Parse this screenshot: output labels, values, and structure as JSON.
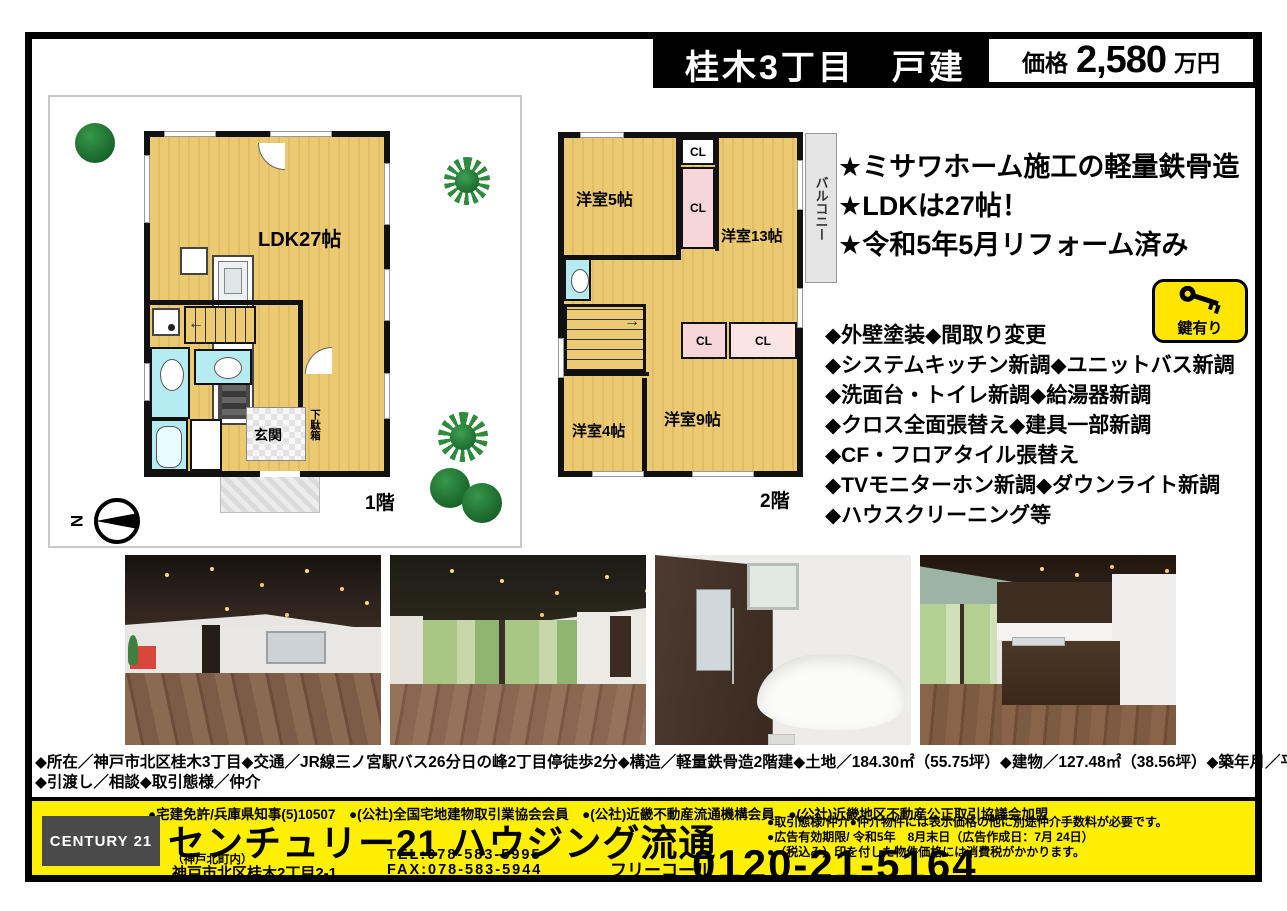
{
  "header": {
    "title": "桂木3丁目　戸建",
    "price_label": "価格",
    "price_value": "2,580",
    "price_unit": "万円"
  },
  "floorplan1": {
    "floor_label": "1階",
    "ldk_label": "LDK27帖",
    "genkan_label": "玄関",
    "shoebox_label": "下駄箱",
    "compass_n": "N"
  },
  "floorplan2": {
    "floor_label": "2階",
    "room5_label": "洋室5帖",
    "room13_label": "洋室13帖",
    "room4_label": "洋室4帖",
    "room9_label": "洋室9帖",
    "closet_label": "CL",
    "balcony_label": "バルコニー"
  },
  "highlights": [
    "★ミサワホーム施工の軽量鉄骨造",
    "★LDKは27帖！",
    "★令和5年5月リフォーム済み"
  ],
  "renovations": [
    "◆外壁塗装◆間取り変更",
    "◆システムキッチン新調◆ユニットバス新調",
    "◆洗面台・トイレ新調◆給湯器新調",
    "◆クロス全面張替え◆建具一部新調",
    "◆CF・フロアタイル張替え",
    "◆TVモニターホン新調◆ダウンライト新調",
    "◆ハウスクリーニング等"
  ],
  "key_badge": {
    "label": "鍵有り",
    "icon": "key-icon"
  },
  "property_details": {
    "line1": "◆所在／神戸市北区桂木3丁目◆交通／JR線三ノ宮駅バス26分日の峰2丁目停徒歩2分◆構造／軽量鉄骨造2階建◆土地／184.30㎡（55.75坪）◆建物／127.48㎡（38.56坪）◆築年月／平成元年4月",
    "line2": "◆引渡し／相談◆取引態様／仲介"
  },
  "footer": {
    "license_line": "●宅建免許/兵庫県知事(5)10507　●(公社)全国宅地建物取引業協会会員　●(公社)近畿不動産流通機構会員　●(公社)近畿地区不動産公正取引協議会加盟",
    "century_logo": "CENTURY 21",
    "company_name": "センチュリー21 ハウジング流通",
    "branch_note": "（神戸北町内）",
    "address": "神戸市北区桂木2丁目2-1",
    "tel": "TEL:078-583-5995",
    "fax": "FAX:078-583-5944",
    "free_call_label": "フリーコール",
    "free_call_number": "0120-21-5164",
    "notes": [
      "●取引態様/仲介●仲介物件には表示価格の他に別途仲介手数料が必要です。",
      "●広告有効期限/ 令和5年　8月末日（広告作成日：7月 24日）",
      "●（税込み）印を付した物件価格には消費税がかかります。"
    ]
  },
  "colors": {
    "banner_yellow": "#ffef00",
    "room_tan": "#ecca74",
    "closet_pink": "#f8d5d8",
    "wet_cyan": "#b5ebf1",
    "key_badge_yellow": "#ffe600",
    "logo_gray": "#4a4a4a"
  },
  "photos": [
    "living-dining-room-1",
    "living-dining-room-2",
    "bathroom",
    "kitchen"
  ]
}
